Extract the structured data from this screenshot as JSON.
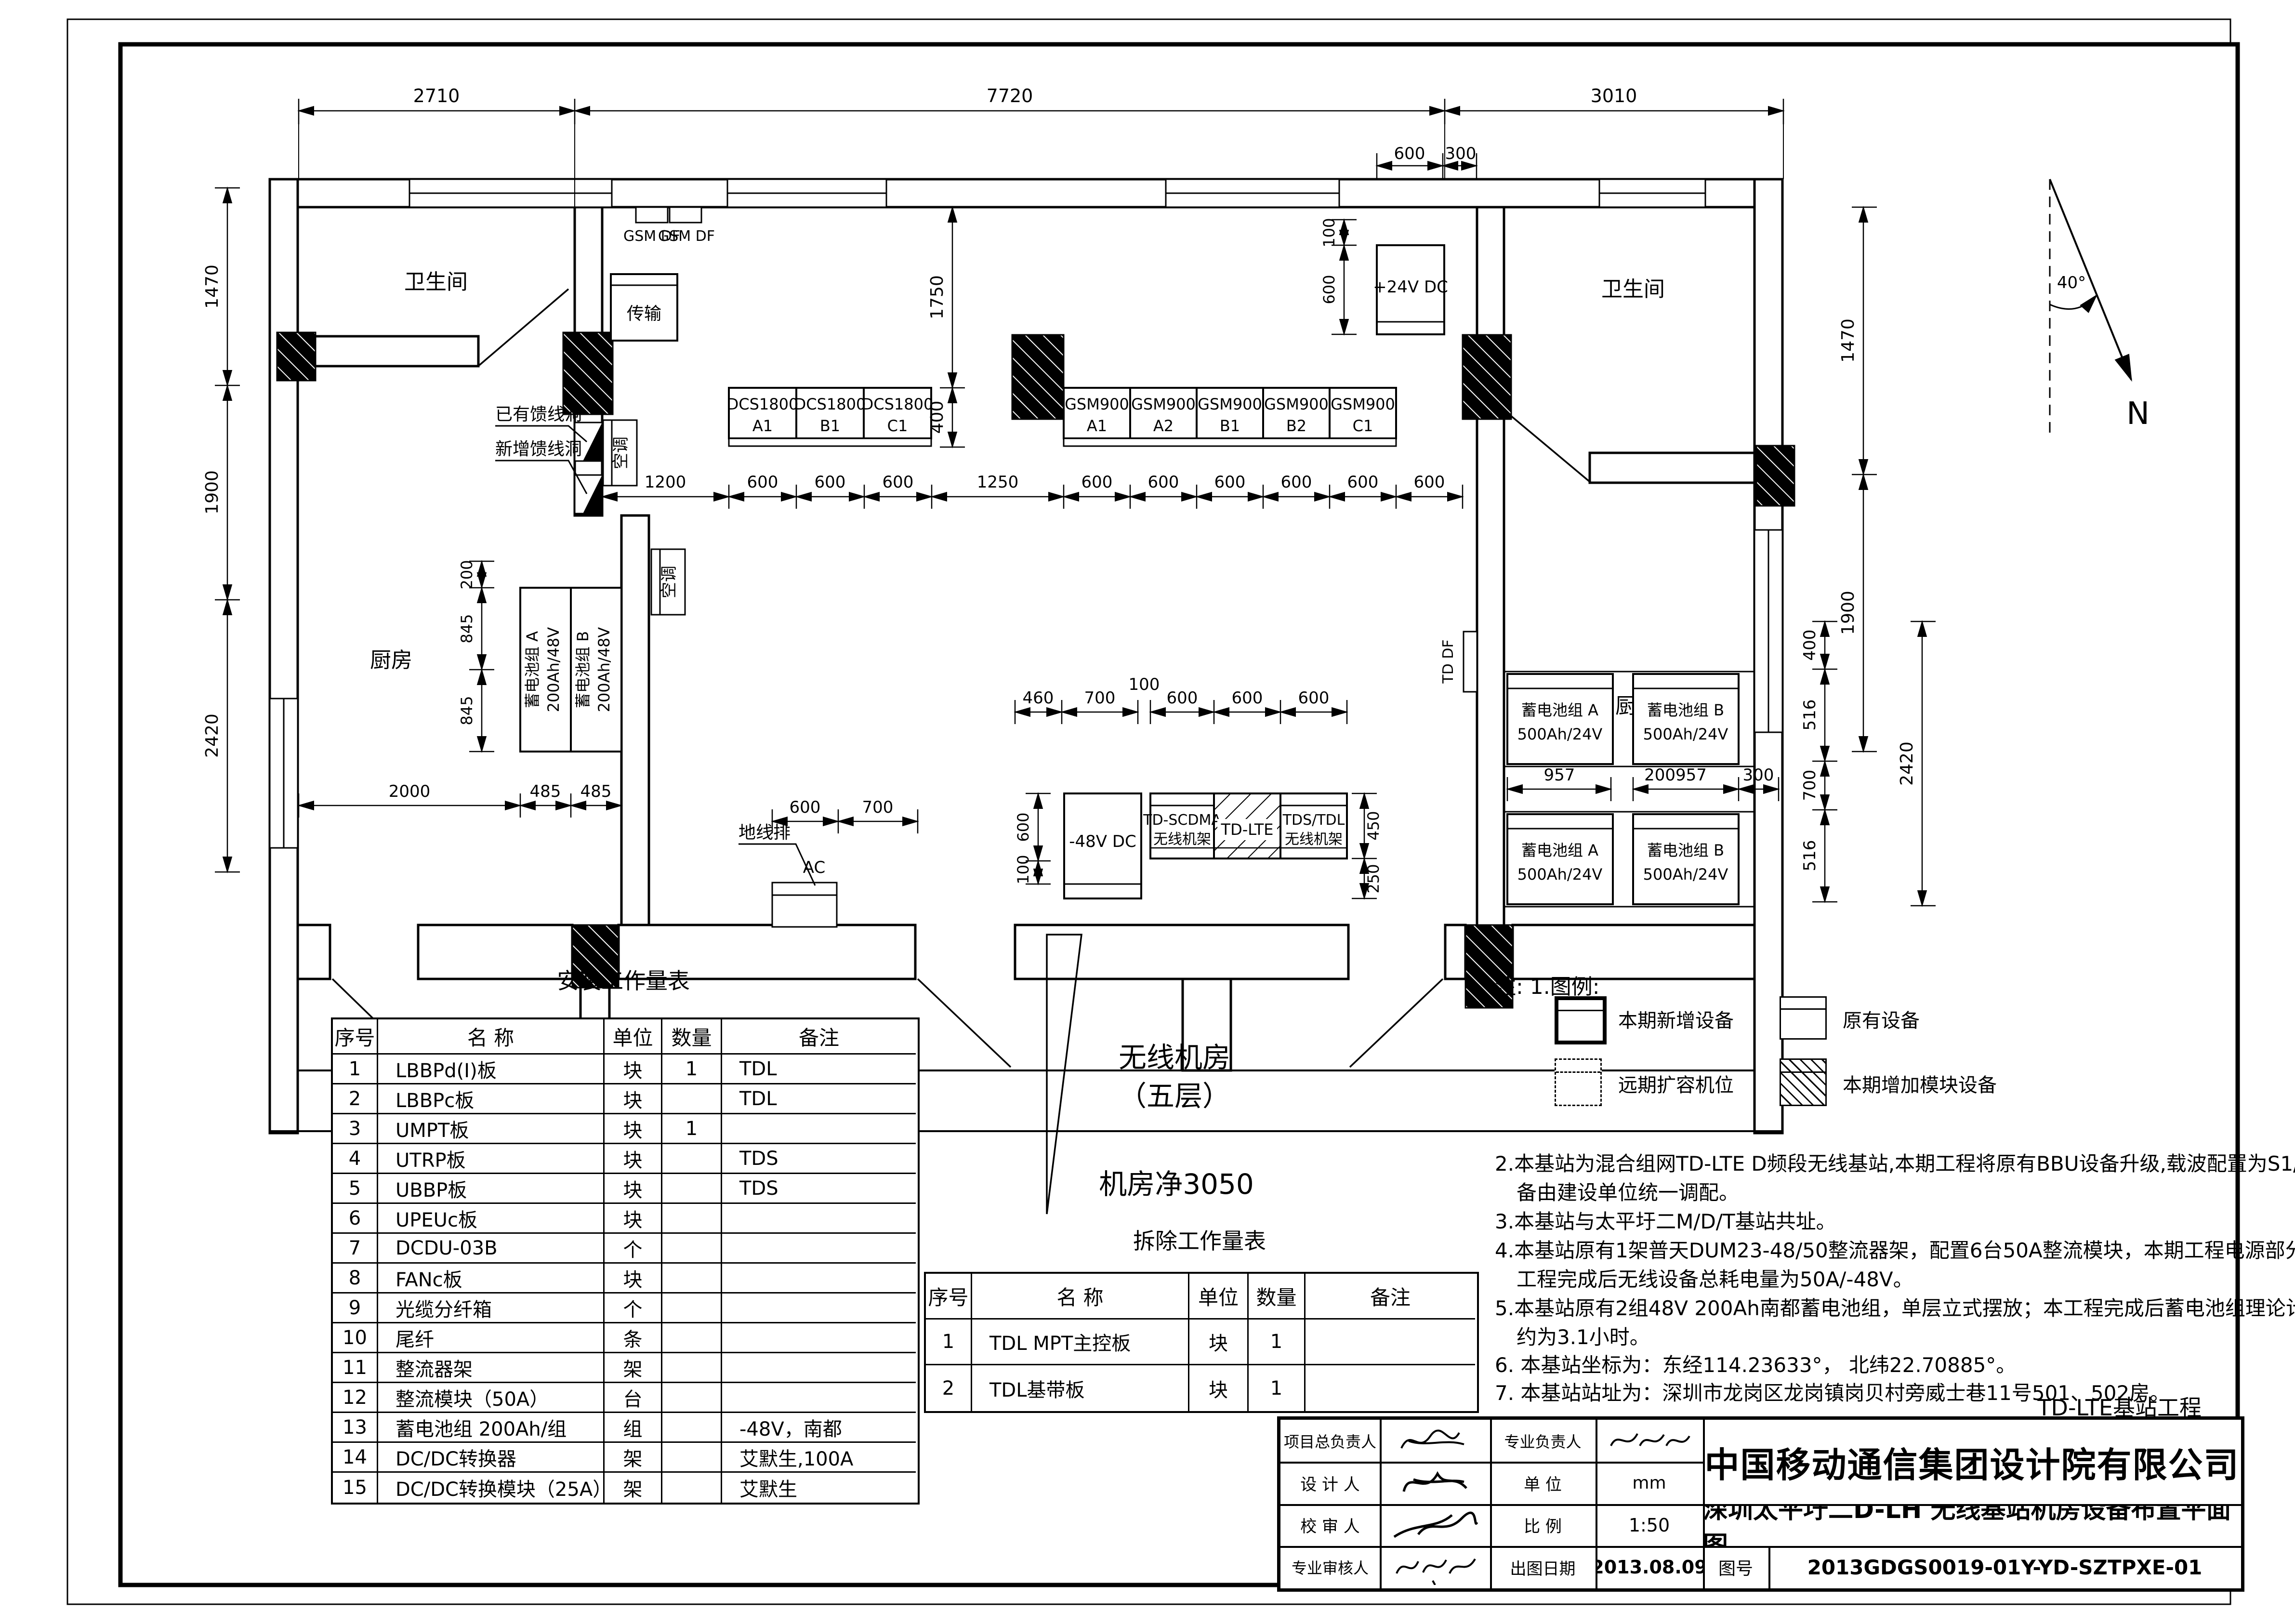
{
  "plan": {
    "rooms": {
      "bath_left": "卫生间",
      "kitchen_left": "厨房",
      "bath_right": "卫生间",
      "kitchen_right": "厨房",
      "name_l1": "无线机房",
      "name_l2": "（五层）",
      "name_l3": "机房净3050"
    },
    "labels": {
      "gsm_df": "GSM DF",
      "transmission": "传输",
      "dc24": "+24V DC",
      "ac": "空调",
      "hole_existing": "已有馈线洞",
      "hole_new": "新增馈线洞",
      "td_df": "TD DF",
      "ground_bar": "地线排",
      "ac_unit": "AC",
      "dc48": "-48V DC",
      "rack1_l1": "TD-SCDMA",
      "rack1_l2": "无线机架",
      "rack2": "TD-LTE",
      "rack3_l1": "TDS/TDL",
      "rack3_l2": "无线机架",
      "north": "N",
      "angle": "40°"
    },
    "equipment": {
      "dcs": [
        {
          "l1": "DCS1800",
          "l2": "A1"
        },
        {
          "l1": "DCS1800",
          "l2": "B1"
        },
        {
          "l1": "DCS1800",
          "l2": "C1"
        }
      ],
      "gsm": [
        {
          "l1": "GSM900",
          "l2": "A1"
        },
        {
          "l1": "GSM900",
          "l2": "A2"
        },
        {
          "l1": "GSM900",
          "l2": "B1"
        },
        {
          "l1": "GSM900",
          "l2": "B2"
        },
        {
          "l1": "GSM900",
          "l2": "C1"
        }
      ],
      "bat_left": [
        {
          "l1": "蓄电池组 A",
          "l2": "200Ah/48V"
        },
        {
          "l1": "蓄电池组 B",
          "l2": "200Ah/48V"
        }
      ],
      "bat_right": [
        {
          "l1": "蓄电池组 A",
          "l2": "500Ah/24V"
        },
        {
          "l1": "蓄电池组 B",
          "l2": "500Ah/24V"
        },
        {
          "l1": "蓄电池组 A",
          "l2": "500Ah/24V"
        },
        {
          "l1": "蓄电池组 B",
          "l2": "500Ah/24V"
        }
      ]
    },
    "dims": {
      "d2710": "2710",
      "d7720": "7720",
      "d3010": "3010",
      "d600": "600",
      "d300": "300",
      "d100": "100",
      "d1470": "1470",
      "d1900": "1900",
      "d2420": "2420",
      "d1750": "1750",
      "d400": "400",
      "d1200": "1200",
      "d1250": "1250",
      "d460": "460",
      "d700": "700",
      "d450": "450",
      "d250": "250",
      "d2000": "2000",
      "d485": "485",
      "d845": "845",
      "d200": "200",
      "d957": "957",
      "d200957": "200957",
      "d516": "516"
    }
  },
  "legend": {
    "heading": "注: 1.图例:",
    "items": [
      {
        "label": "本期新增设备"
      },
      {
        "label": "原有设备"
      },
      {
        "label": "远期扩容机位"
      },
      {
        "label": "本期增加模块设备"
      }
    ]
  },
  "notes": {
    "l1": "2.本基站为混合组网TD-LTE D频段无线基站,本期工程将原有BBU设备升级,载波配置为S1/1/1, 新增设",
    "l2": "备由建设单位统一调配。",
    "l3": "3.本基站与太平圩二M/D/T基站共址。",
    "l4": "4.本基站原有1架普天DUM23-48/50整流器架，配置6台50A整流模块，本期工程电源部分无需扩容；本",
    "l5": "工程完成后无线设备总耗电量为50A/-48V。",
    "l6": "5.本基站原有2组48V 200Ah南都蓄电池组，单层立式摆放；本工程完成后蓄电池组理论计算放电时间",
    "l7": "约为3.1小时。",
    "l8": "6. 本基站坐标为：东经114.23633°， 北纬22.70885°。",
    "l9": "7. 本基站站址为：深圳市龙岗区龙岗镇岗贝村旁威士巷11号501、502房。",
    "project_tag": "TD-LTE基站工程"
  },
  "install_table": {
    "title": "安装工作量表",
    "headers": [
      "序号",
      "名    称",
      "单位",
      "数量",
      "备注"
    ],
    "rows": [
      [
        "1",
        "LBBPd(I)板",
        "块",
        "1",
        "TDL"
      ],
      [
        "2",
        "LBBPc板",
        "块",
        "",
        "TDL"
      ],
      [
        "3",
        "UMPT板",
        "块",
        "1",
        ""
      ],
      [
        "4",
        "UTRP板",
        "块",
        "",
        "TDS"
      ],
      [
        "5",
        "UBBP板",
        "块",
        "",
        "TDS"
      ],
      [
        "6",
        "UPEUc板",
        "块",
        "",
        ""
      ],
      [
        "7",
        "DCDU-03B",
        "个",
        "",
        ""
      ],
      [
        "8",
        "FANc板",
        "块",
        "",
        ""
      ],
      [
        "9",
        "光缆分纤箱",
        "个",
        "",
        ""
      ],
      [
        "10",
        "尾纤",
        "条",
        "",
        ""
      ],
      [
        "11",
        "整流器架",
        "架",
        "",
        ""
      ],
      [
        "12",
        "整流模块（50A）",
        "台",
        "",
        ""
      ],
      [
        "13",
        "蓄电池组 200Ah/组",
        "组",
        "",
        "-48V，南都"
      ],
      [
        "14",
        "DC/DC转换器",
        "架",
        "",
        "艾默生,100A"
      ],
      [
        "15",
        "DC/DC转换模块（25A）",
        "架",
        "",
        "艾默生"
      ]
    ]
  },
  "removal_table": {
    "title": "拆除工作量表",
    "headers": [
      "序号",
      "名    称",
      "单位",
      "数量",
      "备注"
    ],
    "rows": [
      [
        "1",
        "TDL MPT主控板",
        "块",
        "1",
        ""
      ],
      [
        "2",
        "TDL基带板",
        "块",
        "1",
        ""
      ]
    ]
  },
  "title_block": {
    "r1c1": "项目总负责人",
    "r1c3": "专业负责人",
    "r2c1": "设 计 人",
    "r2c3": "单    位",
    "r2c4": "mm",
    "r3c1": "校 审 人",
    "r3c3": "比    例",
    "r3c4": "1:50",
    "r4c1": "专业审核人",
    "r4c3": "出图日期",
    "r4c4": "2013.08.09",
    "company": "中国移动通信集团设计院有限公司",
    "drawing_title": "深圳太平圩二D-LH 无线基站机房设备布置平面图",
    "fig_label": "图号",
    "fig_no": "2013GDGS0019-01Y-YD-SZTPXE-01"
  }
}
